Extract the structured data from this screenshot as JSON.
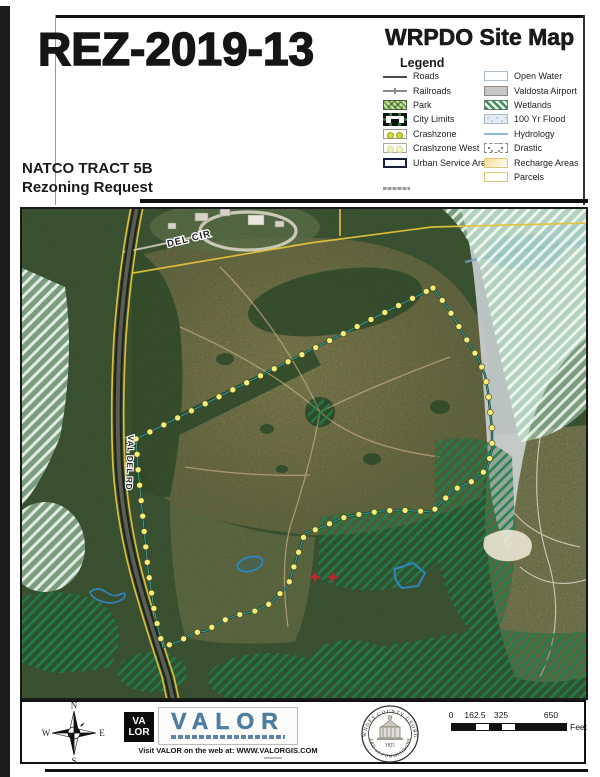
{
  "header": {
    "case_number": "REZ-2019-13",
    "map_title": "WRPDO Site Map",
    "tract_line1": "NATCO TRACT 5B",
    "tract_line2": "Rezoning Request"
  },
  "legend": {
    "title": "Legend",
    "columns": [
      [
        {
          "label": "Roads",
          "swatch": "roads"
        },
        {
          "label": "Railroads",
          "swatch": "railroads"
        },
        {
          "label": "Park",
          "swatch": "park"
        },
        {
          "label": "City Limits",
          "swatch": "citylimits"
        },
        {
          "label": "Crashzone",
          "swatch": "crashzone"
        },
        {
          "label": "Crashzone West",
          "swatch": "crashzonewest"
        },
        {
          "label": "Urban Service Area",
          "swatch": "usa"
        }
      ],
      [
        {
          "label": "Open Water",
          "swatch": "openwater"
        },
        {
          "label": "Valdosta Airport",
          "swatch": "airport"
        },
        {
          "label": "Wetlands",
          "swatch": "wetlands"
        },
        {
          "label": "100 Yr Flood",
          "swatch": "flood"
        },
        {
          "label": "Hydrology",
          "swatch": "hydrology"
        },
        {
          "label": "Drastic",
          "swatch": "drastic"
        },
        {
          "label": "Recharge Areas",
          "swatch": "recharge"
        },
        {
          "label": "Parcels",
          "swatch": "parcels"
        }
      ]
    ]
  },
  "map": {
    "road_label": "VAL DEL RD",
    "circle_label": "DEL CIR",
    "boundary_color": "#16483c",
    "vertex_dot_color": "#f4ef7d",
    "boundary": [
      [
        413,
        81
      ],
      [
        428,
        101
      ],
      [
        438,
        118
      ],
      [
        448,
        135
      ],
      [
        458,
        151
      ],
      [
        465,
        168
      ],
      [
        468,
        185
      ],
      [
        470,
        203
      ],
      [
        472,
        222
      ],
      [
        472,
        242
      ],
      [
        467,
        262
      ],
      [
        453,
        274
      ],
      [
        433,
        283
      ],
      [
        422,
        295
      ],
      [
        412,
        305
      ],
      [
        395,
        304
      ],
      [
        378,
        303
      ],
      [
        362,
        304
      ],
      [
        348,
        306
      ],
      [
        335,
        308
      ],
      [
        322,
        311
      ],
      [
        311,
        316
      ],
      [
        298,
        322
      ],
      [
        285,
        326
      ],
      [
        277,
        350
      ],
      [
        268,
        379
      ],
      [
        249,
        397
      ],
      [
        233,
        405
      ],
      [
        217,
        408
      ],
      [
        200,
        415
      ],
      [
        186,
        424
      ],
      [
        173,
        426
      ],
      [
        160,
        434
      ],
      [
        143,
        440
      ],
      [
        138,
        421
      ],
      [
        134,
        402
      ],
      [
        131,
        382
      ],
      [
        128,
        362
      ],
      [
        126,
        342
      ],
      [
        124,
        322
      ],
      [
        122,
        302
      ],
      [
        120,
        282
      ],
      [
        118,
        262
      ],
      [
        117,
        246
      ],
      [
        116,
        232
      ]
    ]
  },
  "footer": {
    "compass": {
      "n": "N",
      "e": "E",
      "s": "S",
      "w": "W"
    },
    "valor": {
      "mark_line1": "VA",
      "mark_line2": "LOR",
      "name": "VALOR",
      "website_line": "Visit VALOR on the web at: WWW.VALORGIS.COM"
    },
    "seal": {
      "top_text": "LOWNDES COUNTY GEORGIA",
      "year": "1825",
      "bottom_text": "BOARD of COMMISSIONERS"
    },
    "scalebar": {
      "ticks": [
        "0",
        "162.5",
        "325",
        "650"
      ],
      "tick_offsets": [
        0,
        24,
        50,
        100
      ],
      "segments": [
        24,
        13,
        13,
        13,
        51
      ],
      "unit": "Feet"
    }
  }
}
